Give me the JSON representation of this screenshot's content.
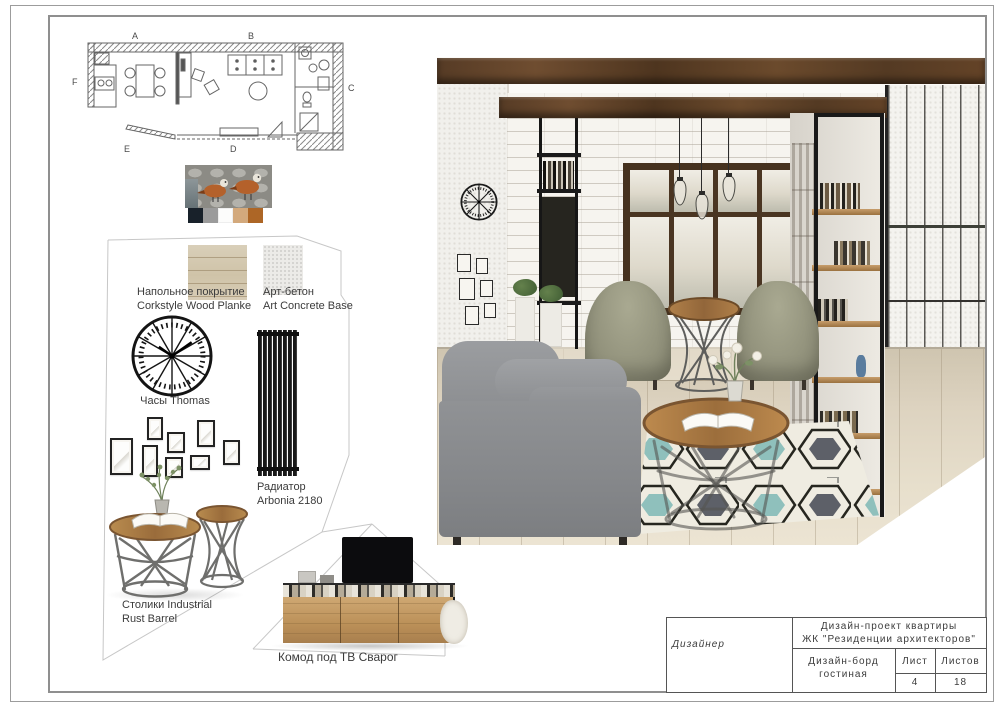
{
  "floor_plan": {
    "labels": [
      "A",
      "B",
      "C",
      "D",
      "E",
      "F"
    ]
  },
  "palette": {
    "colors": [
      "#18212a",
      "#9b9b9b",
      "#fcfcfb",
      "#d3a97c",
      "#ad6626"
    ]
  },
  "materials": {
    "flooring": {
      "line1": "Напольное покрытие",
      "line2": "Corkstyle Wood Planke"
    },
    "concrete": {
      "line1": "Арт-бетон",
      "line2": "Art Concrete Base"
    }
  },
  "items": {
    "clock": {
      "label": "Часы Thomas"
    },
    "radiator": {
      "line1": "Радиатор",
      "line2": "Arbonia 2180"
    },
    "tables": {
      "line1": "Столики Industrial",
      "line2": "Rust Barrel"
    },
    "tv_stand": {
      "label": "Комод под ТВ Сварог"
    }
  },
  "key_colors": {
    "beam_wood": "#5b3c26",
    "armchair_sage": "#95957e",
    "sofa_gray": "#8f9193",
    "rug_teal": "#8fc0bc",
    "rug_slate": "#5d6068"
  },
  "title_block": {
    "designer": "Дизайнер",
    "project_line1": "Дизайн-проект квартиры",
    "project_line2": "ЖК \"Резиденции архитекторов\"",
    "board_line1": "Дизайн-борд",
    "board_line2": "гостиная",
    "sheet_label": "Лист",
    "total_label": "Листов",
    "sheet_value": "4",
    "total_value": "18"
  }
}
